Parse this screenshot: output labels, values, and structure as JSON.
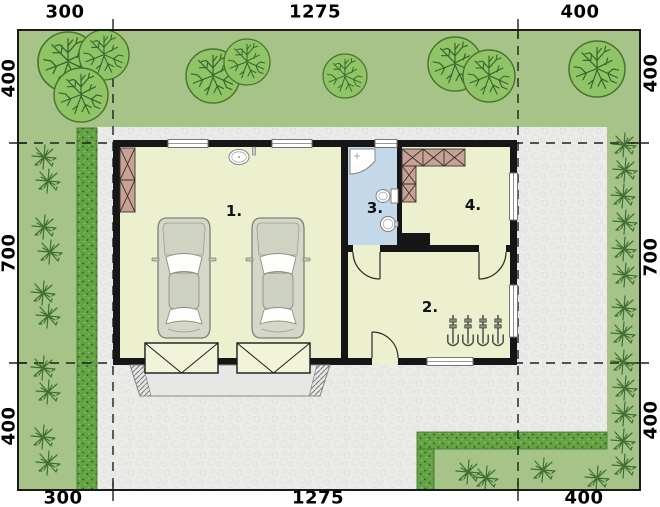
{
  "plan": {
    "dimensions": {
      "top": [
        "300",
        "1275",
        "400"
      ],
      "bottom": [
        "300",
        "1275",
        "400"
      ],
      "left": [
        "400",
        "700",
        "400"
      ],
      "right": [
        "400",
        "700",
        "400"
      ]
    },
    "rooms": [
      {
        "label": "1."
      },
      {
        "label": "2."
      },
      {
        "label": "3."
      },
      {
        "label": "4."
      }
    ],
    "site": {
      "trees": [
        {
          "x": 68,
          "y": 62,
          "r": 30
        },
        {
          "x": 104,
          "y": 55,
          "r": 25
        },
        {
          "x": 81,
          "y": 95,
          "r": 27
        },
        {
          "x": 213,
          "y": 76,
          "r": 27
        },
        {
          "x": 247,
          "y": 62,
          "r": 23
        },
        {
          "x": 345,
          "y": 76,
          "r": 22
        },
        {
          "x": 455,
          "y": 64,
          "r": 27
        },
        {
          "x": 489,
          "y": 76,
          "r": 26
        },
        {
          "x": 597,
          "y": 69,
          "r": 28
        }
      ],
      "shrubs": [
        {
          "x": 44,
          "y": 157
        },
        {
          "x": 48,
          "y": 181
        },
        {
          "x": 44,
          "y": 227
        },
        {
          "x": 50,
          "y": 252
        },
        {
          "x": 43,
          "y": 293
        },
        {
          "x": 48,
          "y": 316
        },
        {
          "x": 43,
          "y": 368
        },
        {
          "x": 48,
          "y": 392
        },
        {
          "x": 43,
          "y": 437
        },
        {
          "x": 48,
          "y": 463
        },
        {
          "x": 624,
          "y": 145
        },
        {
          "x": 625,
          "y": 170
        },
        {
          "x": 623,
          "y": 196
        },
        {
          "x": 625,
          "y": 222
        },
        {
          "x": 624,
          "y": 249
        },
        {
          "x": 625,
          "y": 275
        },
        {
          "x": 624,
          "y": 308
        },
        {
          "x": 623,
          "y": 334
        },
        {
          "x": 623,
          "y": 362
        },
        {
          "x": 625,
          "y": 388
        },
        {
          "x": 624,
          "y": 414
        },
        {
          "x": 623,
          "y": 441
        },
        {
          "x": 624,
          "y": 466
        },
        {
          "x": 468,
          "y": 472
        },
        {
          "x": 486,
          "y": 478
        },
        {
          "x": 543,
          "y": 470
        },
        {
          "x": 597,
          "y": 478
        }
      ],
      "tools": [
        {
          "x": 453,
          "y": 315
        },
        {
          "x": 468,
          "y": 315
        },
        {
          "x": 483,
          "y": 315
        },
        {
          "x": 498,
          "y": 315
        }
      ]
    },
    "colors": {
      "grass": "#a6c487",
      "hedge": "#63a344",
      "paving": "#ebebe9",
      "wall": "#161616",
      "floor": "#edf0ce",
      "bathroom_floor": "#c3d8e9",
      "furniture": "#c9a192",
      "tree": "#90c467",
      "garage_door": "#f2f4da",
      "white": "#ffffff"
    }
  }
}
